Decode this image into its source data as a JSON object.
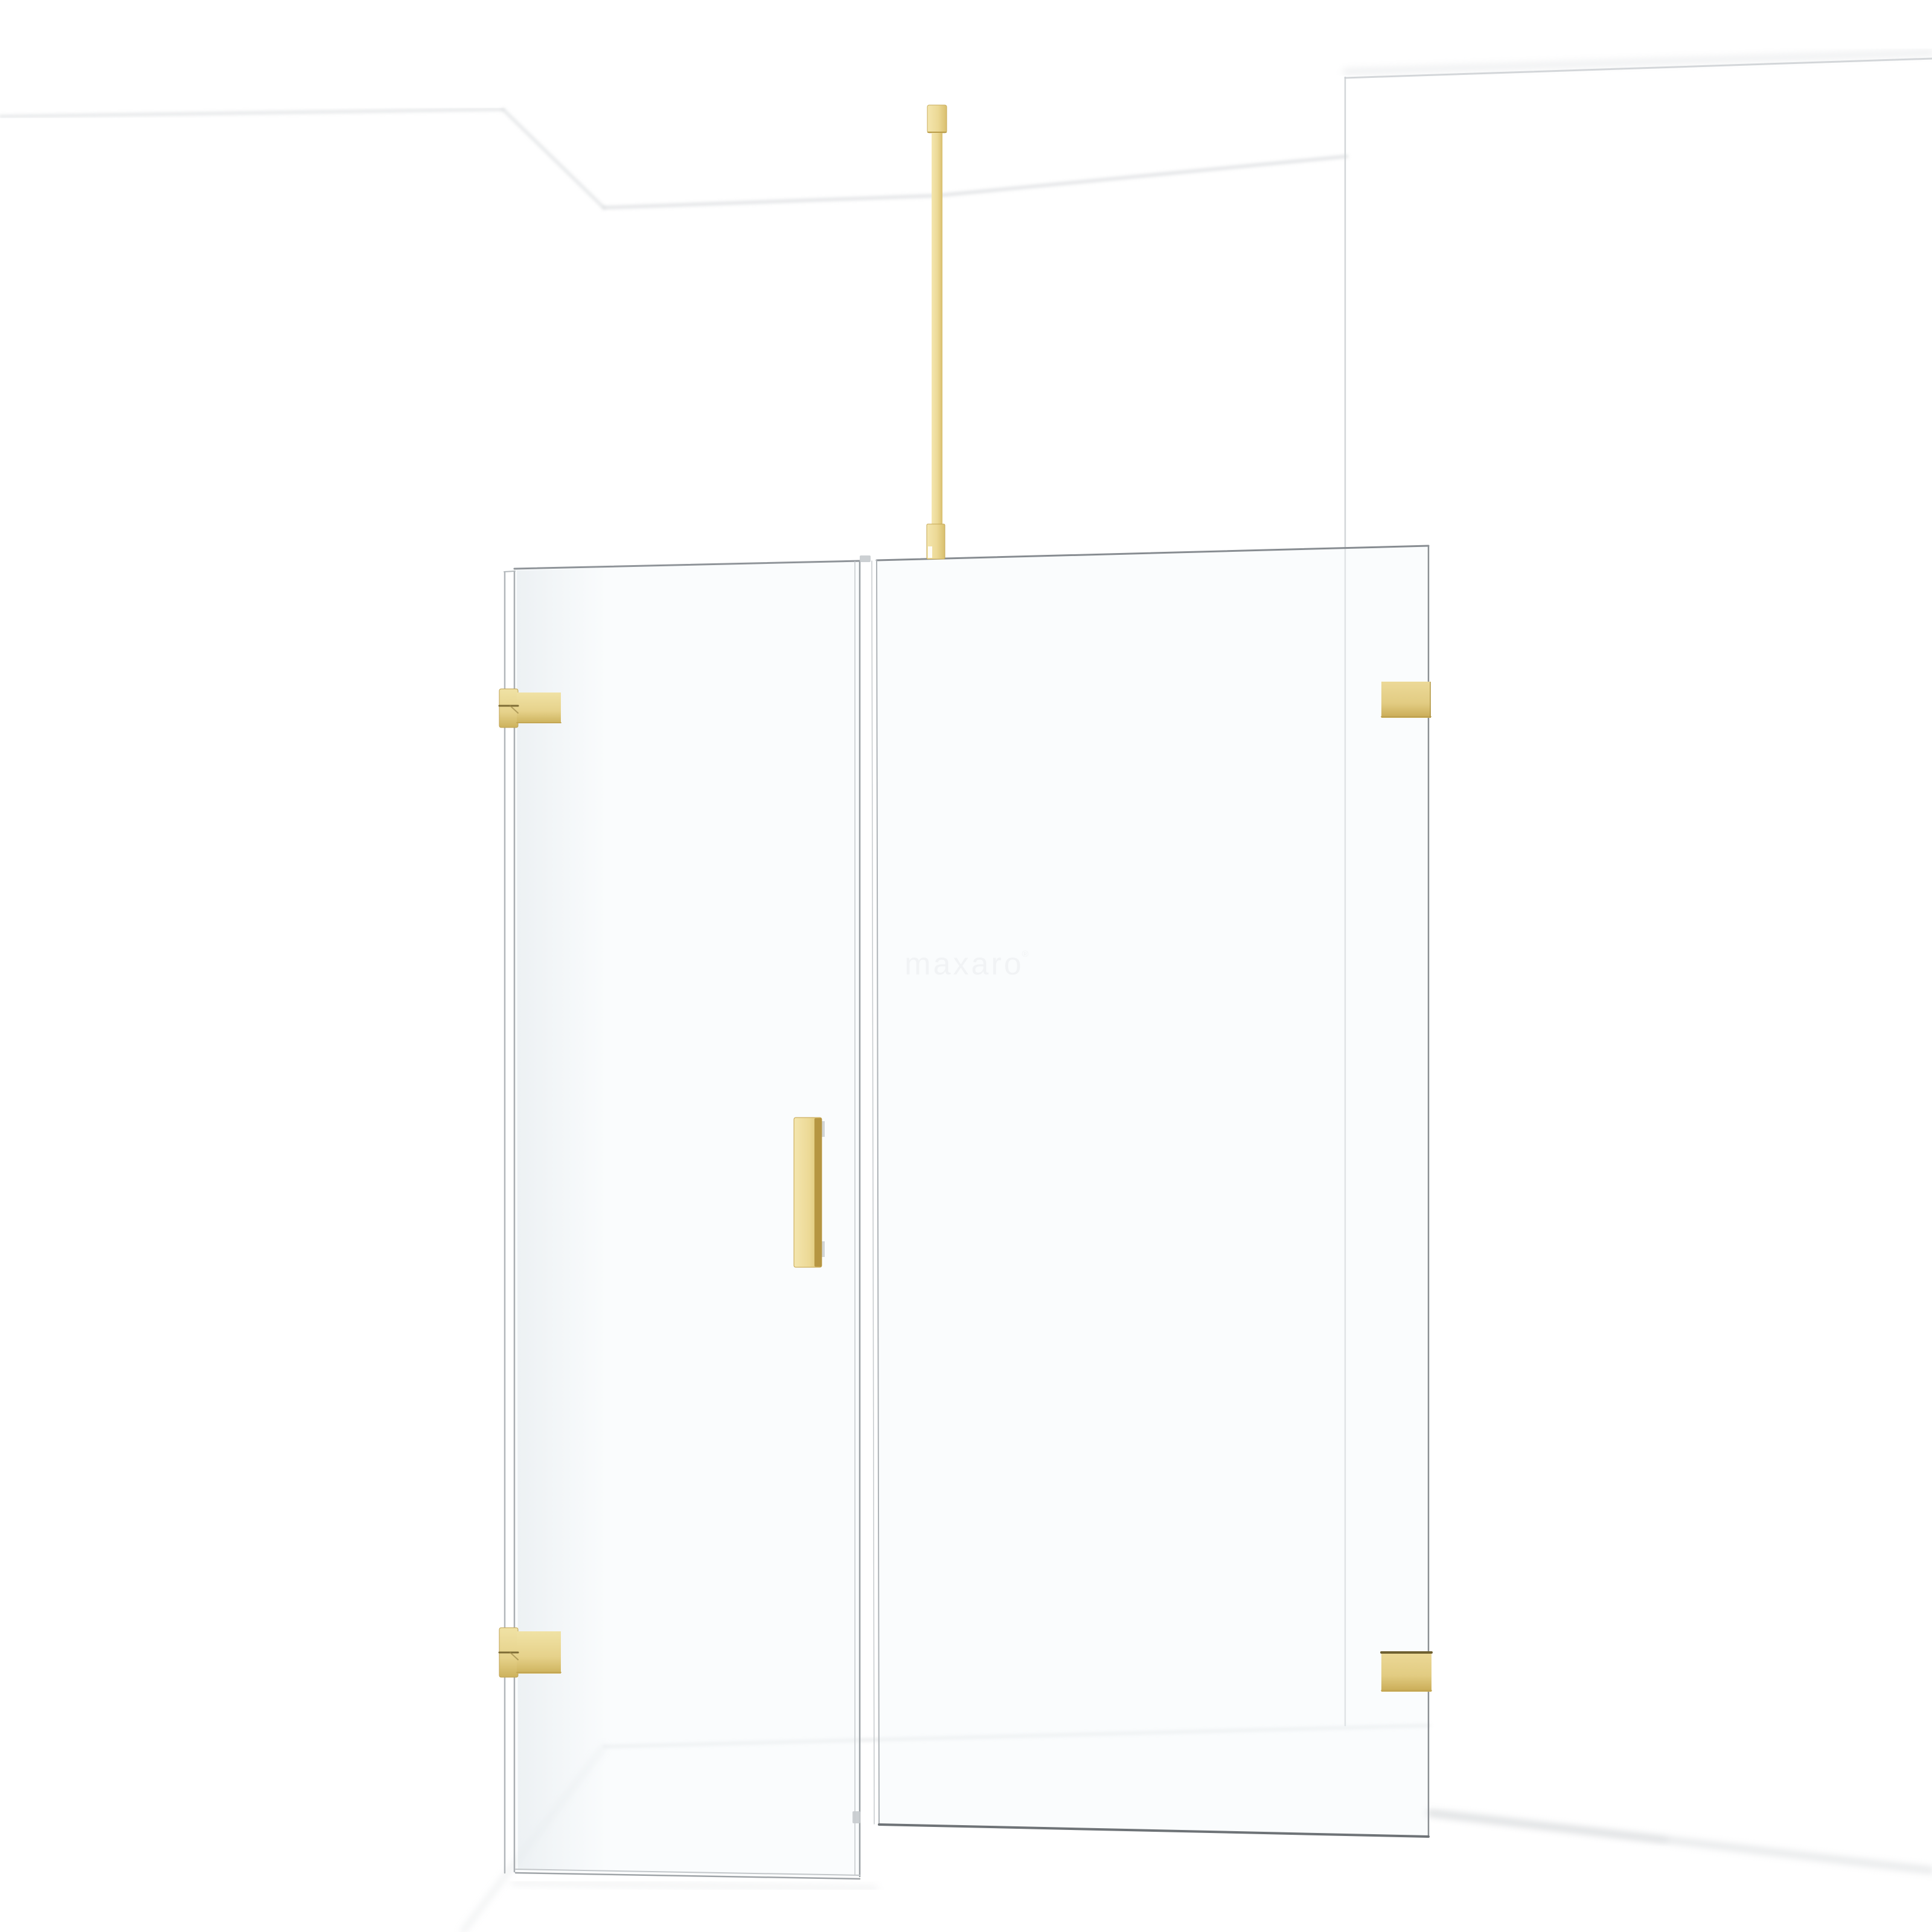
{
  "watermark": {
    "text": "maxaro",
    "registered_mark": "®"
  },
  "colors": {
    "background": "#ffffff",
    "gold": "#e8d690",
    "gold_light": "#f4e6ae",
    "gold_dark": "#c9a852",
    "gold_edge": "#a8873d",
    "gold_seam": "#7e6c35",
    "glass_line": "#a9aeb2",
    "glass_line_dark": "#6e7377",
    "glass_tint": "rgba(243,247,249,0.40)",
    "wall_shadow": "#c7cbcf",
    "watermark_color": "#f1f1f2"
  }
}
